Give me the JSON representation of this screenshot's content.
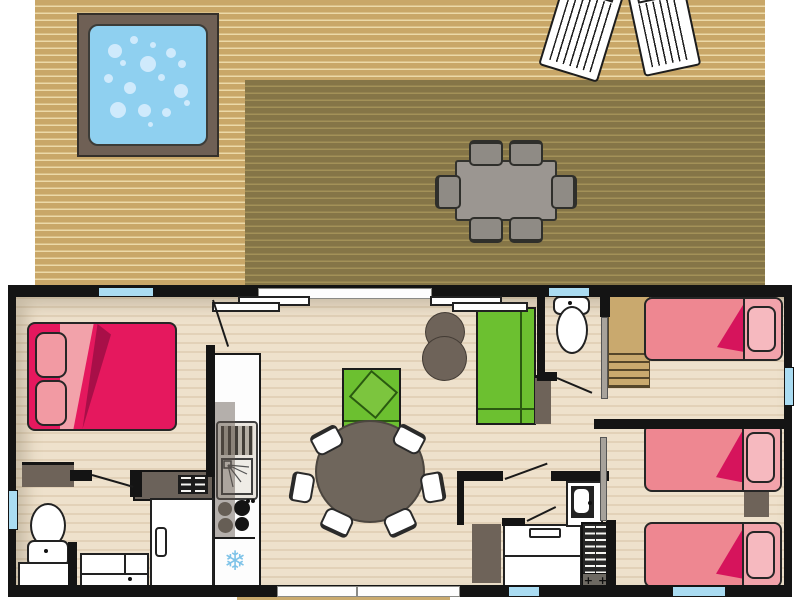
{
  "title": "Three-bedroom mobile home floor plan with terrace deck",
  "icons": {
    "fridge_snowflake": "❄",
    "utility_cross": "+"
  },
  "palette": {
    "deck_light": "#c9a768",
    "deck_stripe": "#ecd9a8",
    "deck_dark": "#857547",
    "deck_dark_stripe": "#a39158",
    "hot_tub_frame": "#6f6055",
    "hot_tub_water": "#8fd0f0",
    "bubble": "#cfeafc",
    "lounger_white": "#ffffff",
    "outdoor_table": "#9b9691",
    "outdoor_chair": "#8f8b85",
    "wall": "#141414",
    "floor": "#eee1cc",
    "window_blue": "#aadcf2",
    "bay_white": "#fdfdfd",
    "bed_double": "#e5185e",
    "bed_double_fold": "#a80f48",
    "bed_double_sheet": "#f2a2aa",
    "pillow_double": "#f29aa3",
    "bed_single": "#ee8791",
    "bed_single_fold": "#d6145c",
    "bed_single_head": "#f2a3ab",
    "pillow_single": "#f6b9bf",
    "green_sofa": "#6cc030",
    "taupe": "#6e6359",
    "table_round": "#6f665c",
    "chair_white": "#ffffff",
    "stairs_tan": "#c9a96e",
    "snowflake_blue": "#7ec3e8",
    "step_tan": "#c9aa6e"
  },
  "rooms": [
    {
      "name": "terrace-deck",
      "items": [
        "hot-tub-with-bubbles",
        "sun-lounger",
        "sun-lounger",
        "covered-pergola-area",
        "outdoor-dining-table",
        "six-outdoor-chairs"
      ]
    },
    {
      "name": "master-bedroom",
      "items": [
        "double-bed-with-two-pillows",
        "wardrobe-block",
        "window",
        "hinged-door"
      ]
    },
    {
      "name": "family-bathroom",
      "items": [
        "toilet",
        "vanity-counter",
        "washbasin-cabinet",
        "shower-cubicle",
        "side-window",
        "hinged-door"
      ]
    },
    {
      "name": "kitchen",
      "items": [
        "worktop-column",
        "sink-with-drainer",
        "four-burner-hob",
        "refrigerator",
        "counter-with-vent-grill"
      ]
    },
    {
      "name": "living-dining-room",
      "items": [
        "green-armchair-with-cushion",
        "two-poufs",
        "green-sofa",
        "round-dining-table",
        "six-chairs",
        "sliding-bay-door",
        "bottom-bay-window",
        "side-cabinet"
      ]
    },
    {
      "name": "separate-wc",
      "items": [
        "toilet",
        "window",
        "hinged-door"
      ]
    },
    {
      "name": "shower-room",
      "items": [
        "washbasin-unit",
        "shower-cubicle",
        "water-heater-unit",
        "storage-cabinet",
        "hinged-door"
      ]
    },
    {
      "name": "bedroom-2",
      "items": [
        "single-bed",
        "storage-steps",
        "sliding-door",
        "side-window"
      ]
    },
    {
      "name": "bedroom-3",
      "items": [
        "single-bed",
        "single-bed",
        "nightstand",
        "sliding-door",
        "windows"
      ]
    },
    {
      "name": "exterior",
      "items": [
        "entrance-step"
      ]
    }
  ]
}
